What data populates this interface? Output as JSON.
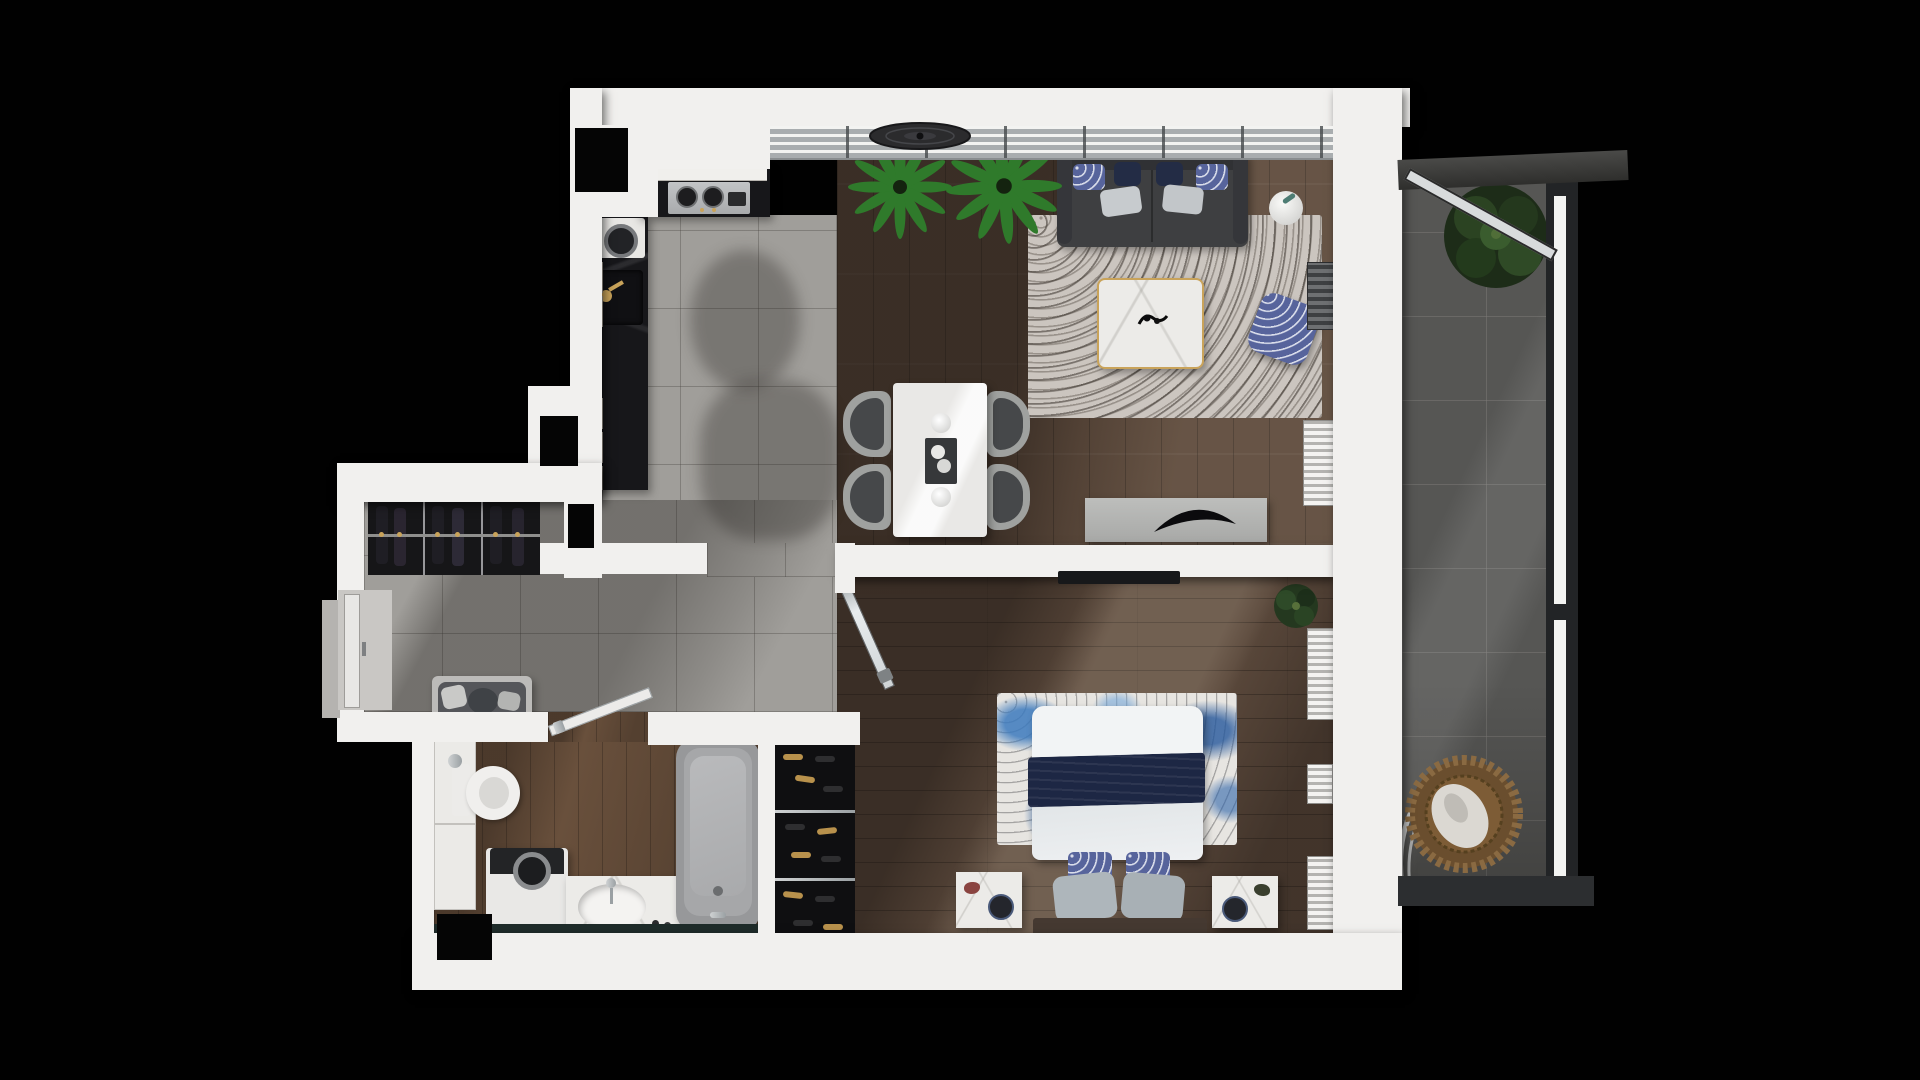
{
  "meta": {
    "title": "One-bedroom apartment - 3D top-down floor plan render",
    "visible_text": "none"
  },
  "palette": {
    "background": "#010101",
    "walls": "#f1f0ee",
    "tile_floor": "#a09e9a",
    "wood_living": "#5e4b3d",
    "wood_bedroom": "#5a483b",
    "wood_bath": "#69503c",
    "balcony_tile": "#565654",
    "kitchen_counter": "#17171a",
    "sofa": "#3e3f41",
    "accent_gold": "#c9a35a",
    "accent_navy": "#1d2744",
    "rug_gray": "#cbc5bf",
    "rug_blue": "#3c7abe",
    "plant_green": "#2f7a2b",
    "railing": "#2a2c2e"
  },
  "rooms": {
    "kitchen": {
      "label": "Kitchen",
      "furniture": [
        "black marble counter",
        "washing appliance",
        "sink with gold faucet",
        "cooktop with hob",
        "beige cabinet fronts",
        "wall niche"
      ]
    },
    "living": {
      "label": "Living room",
      "furniture": [
        "ceiling fan",
        "window band",
        "two palm plants",
        "charcoal sofa with 6 pillows",
        "gray shag rug",
        "marble coffee table with gold trim",
        "round side table with plant",
        "patterned armchair",
        "media console with black sculpture",
        "curtain stacks"
      ]
    },
    "dining": {
      "label": "Dining area",
      "furniture": [
        "white marble table",
        "dark serving tray",
        "two plates",
        "four gray chairs"
      ]
    },
    "hall": {
      "label": "Entry hall",
      "furniture": [
        "entry door",
        "open wardrobe with hanging clothes",
        "bench with cushions"
      ]
    },
    "bathroom": {
      "label": "Bathroom",
      "furniture": [
        "tall cabinet",
        "toilet",
        "washing machine",
        "marble vanity with oval sink",
        "bathtub",
        "interior door"
      ]
    },
    "bedroom": {
      "label": "Bedroom",
      "furniture": [
        "double bed with navy throw",
        "blue abstract rug",
        "two marble nightstands",
        "wall TV",
        "glass door",
        "shoe closet",
        "potted plant",
        "folded-linen shelves"
      ]
    },
    "balcony": {
      "label": "Balcony",
      "furniture": [
        "glass railing",
        "open slider panel",
        "green tree",
        "hanging rattan egg chair"
      ]
    }
  },
  "counts": {
    "sofa_pillows": 6,
    "dining_chairs": 4,
    "bed_pillows": 4,
    "wardrobe_sections": 3,
    "shoe_shelves": 3
  }
}
